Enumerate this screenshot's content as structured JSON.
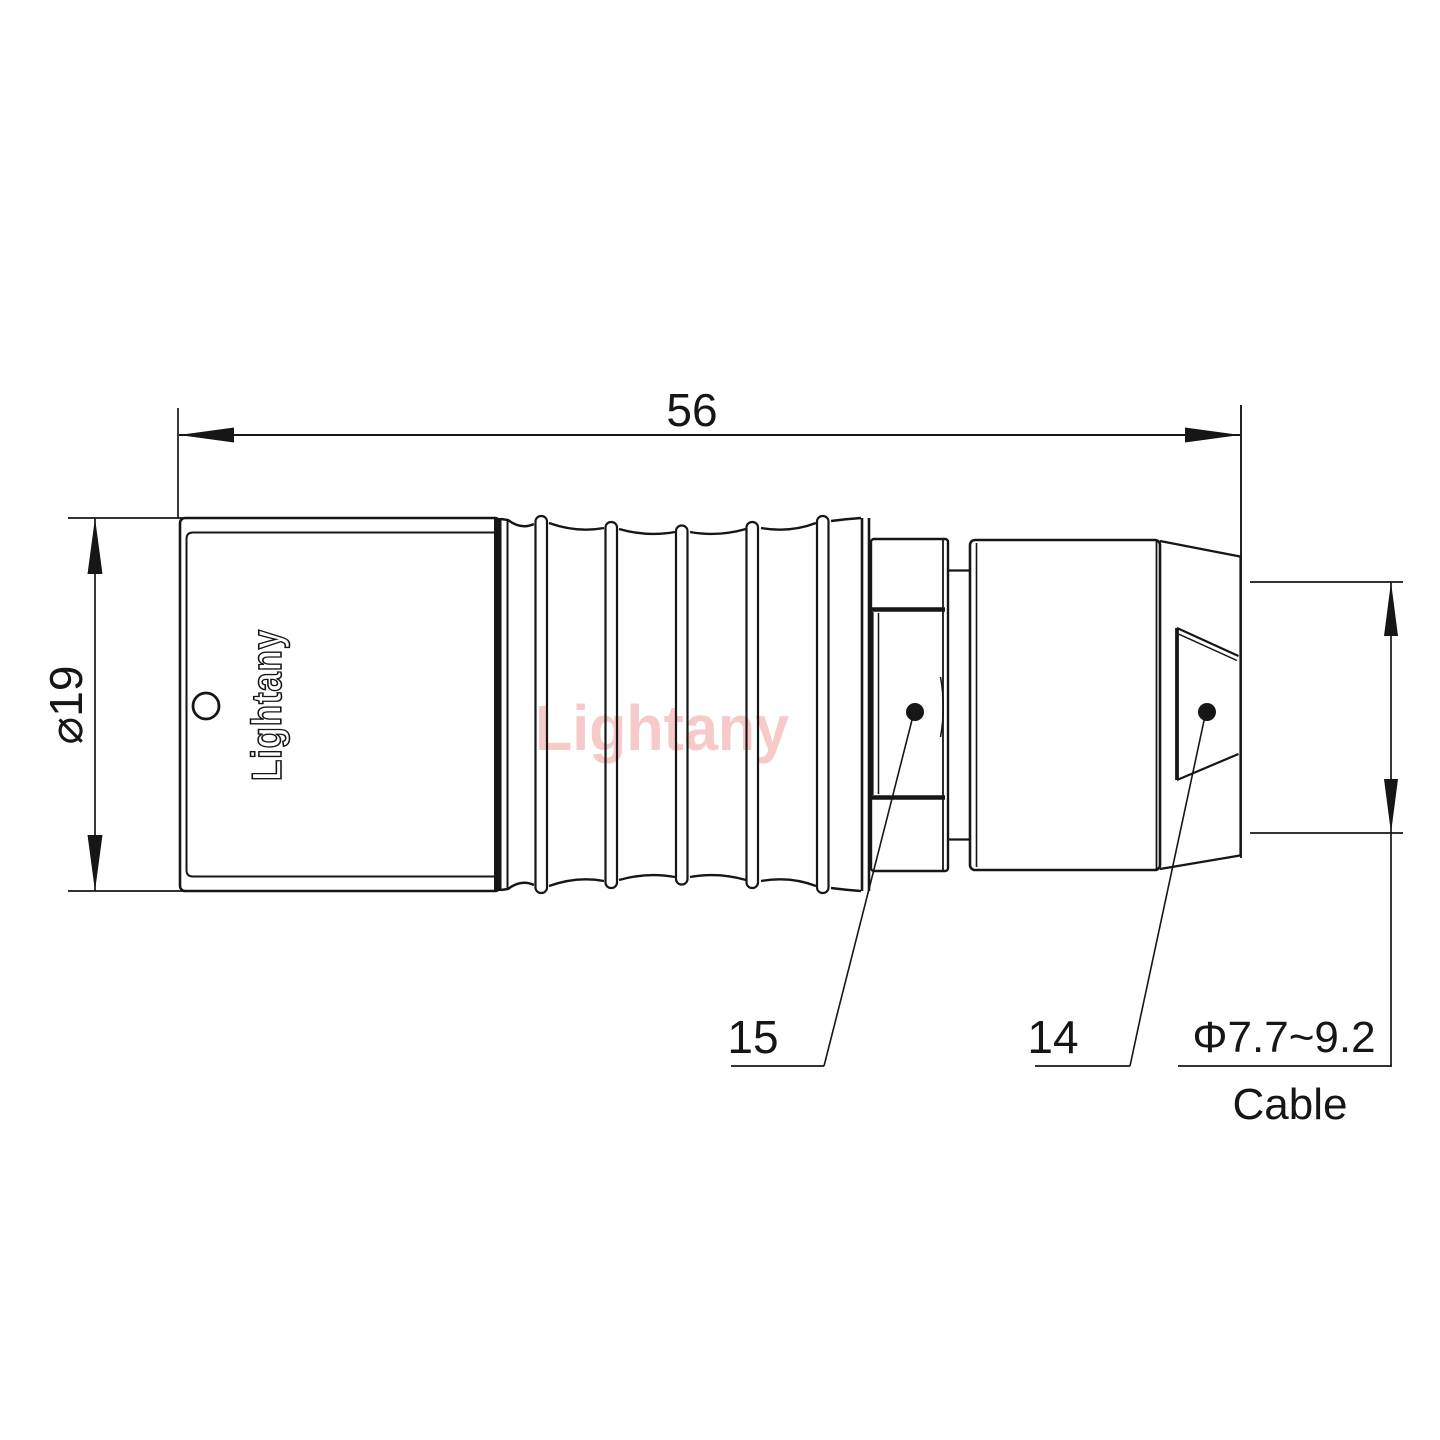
{
  "drawing": {
    "title": "connector-outline-drawing",
    "dim_length": "56",
    "dim_diameter": "⌀19",
    "part_labels": {
      "nut": "15",
      "backshell": "14"
    },
    "cable": {
      "diameter_range": "Φ7.7~9.2",
      "label": "Cable"
    },
    "branding": {
      "logo": "Lightany",
      "watermark": "Lightany"
    },
    "colors": {
      "line": "#161616",
      "watermark": "#f7caca",
      "background": "#ffffff"
    }
  }
}
